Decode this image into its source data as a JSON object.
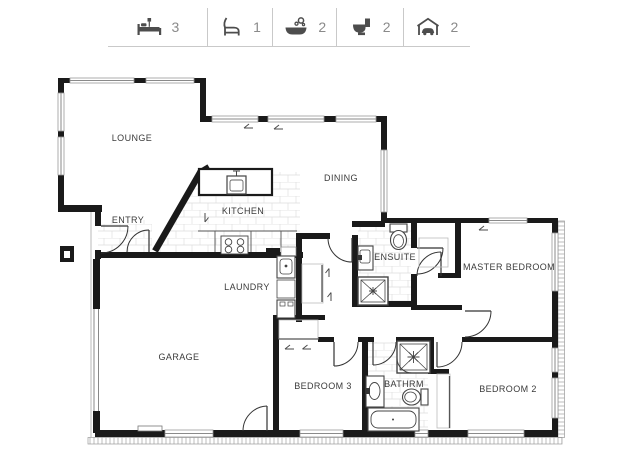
{
  "property_summary": {
    "items": [
      {
        "name": "bedrooms",
        "icon": "bed-icon",
        "count": "3"
      },
      {
        "name": "living-rooms",
        "icon": "armchair-icon",
        "count": "1"
      },
      {
        "name": "bathrooms",
        "icon": "bath-icon",
        "count": "2"
      },
      {
        "name": "toilets",
        "icon": "toilet-icon",
        "count": "2"
      },
      {
        "name": "garage-spaces",
        "icon": "garage-icon",
        "count": "2"
      }
    ]
  },
  "floor_plan": {
    "rooms": [
      {
        "id": "lounge",
        "label": "LOUNGE"
      },
      {
        "id": "entry",
        "label": "ENTRY"
      },
      {
        "id": "kitchen",
        "label": "KITCHEN"
      },
      {
        "id": "dining",
        "label": "DINING"
      },
      {
        "id": "ensuite",
        "label": "ENSUITE"
      },
      {
        "id": "master-bedroom",
        "label": "MASTER BEDROOM"
      },
      {
        "id": "laundry",
        "label": "LAUNDRY"
      },
      {
        "id": "garage",
        "label": "GARAGE"
      },
      {
        "id": "bedroom-3",
        "label": "BEDROOM 3"
      },
      {
        "id": "bathroom",
        "label": "BATHRM"
      },
      {
        "id": "bedroom-2",
        "label": "BEDROOM 2"
      }
    ]
  },
  "colors": {
    "wall": "#1a1a1a",
    "window_line": "#8a8a8a",
    "tile_line": "#dedede",
    "label_text": "#3b3b3b",
    "icon": "#4d4d4d",
    "count_text": "#8a8a8a",
    "divider": "#c9c9c9"
  }
}
